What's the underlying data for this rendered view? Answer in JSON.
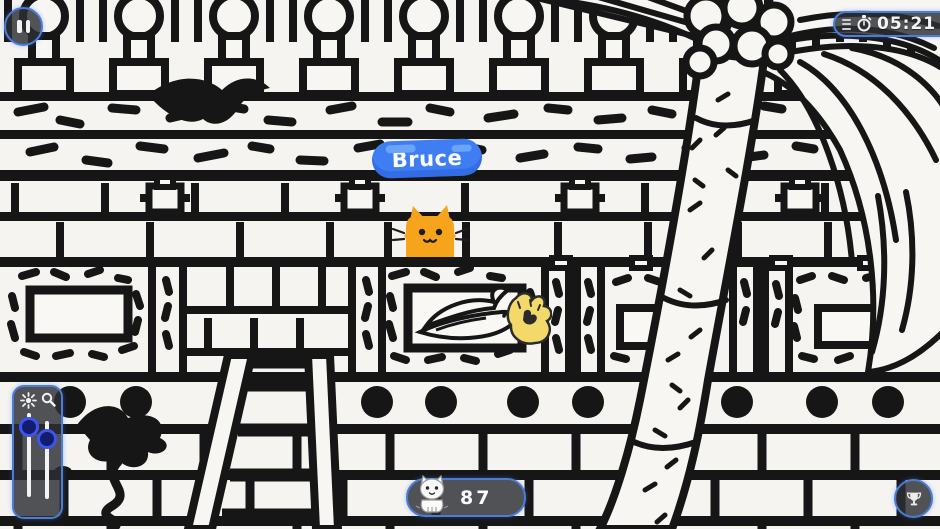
{
  "hud": {
    "pause": {
      "icon": "pause-icon"
    },
    "timer": {
      "menu_icon": "menu-lines-icon",
      "stopwatch_icon": "stopwatch-icon",
      "time": "05:21",
      "fraction": "02"
    },
    "sliders": {
      "left_icon": "brightness-icon",
      "right_icon": "magnifier-icon"
    },
    "counter": {
      "icon": "cat-icon",
      "count": "87"
    },
    "trophy": {
      "icon": "trophy-icon"
    }
  },
  "found_cat": {
    "name": "Bruce",
    "color": "#f6a41c"
  },
  "collectible": {
    "name": "yellow-paw",
    "color": "#f2d96a"
  },
  "colors": {
    "background": "#f5f4f1",
    "ink": "#161616",
    "hud_fill": "rgba(44,46,51,0.82)",
    "hud_border": "#4a7dd8",
    "label_blue": "#3e7ef2",
    "label_blue_light": "#6aa3f7",
    "slider_knob_ring": "#3d55ee"
  }
}
